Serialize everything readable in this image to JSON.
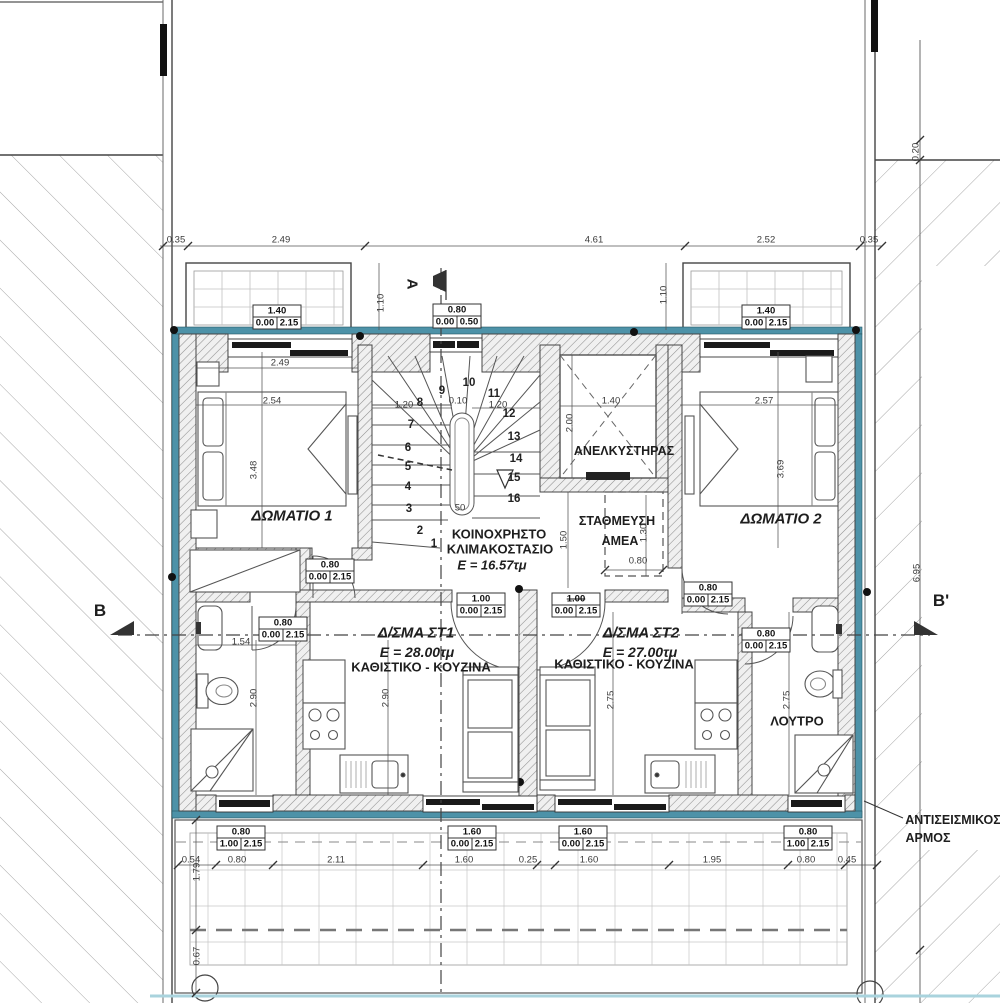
{
  "colors": {
    "insulation_teal": "#4d92a8",
    "pavement_line": "#a9d3dd",
    "wall_hatch": "#8f8f8f",
    "line": "#333333"
  },
  "labels": [
    {
      "name": "room-1-label",
      "text": "ΔΩΜΑΤΙΟ 1",
      "x": 292,
      "y": 516,
      "fs": 15,
      "b": 1,
      "i": 1
    },
    {
      "name": "room-2-label",
      "text": "ΔΩΜΑΤΙΟ 2",
      "x": 781,
      "y": 519,
      "fs": 15,
      "b": 1,
      "i": 1
    },
    {
      "name": "stairwell-label-line1",
      "text": "ΚΟΙΝΟΧΡΗΣΤΟ",
      "x": 499,
      "y": 534,
      "fs": 13,
      "b": 1
    },
    {
      "name": "stairwell-label-line2",
      "text": "ΚΛΙΜΑΚΟΣΤΑΣΙΟ",
      "x": 500,
      "y": 549,
      "fs": 13,
      "b": 1
    },
    {
      "name": "stairwell-area-label",
      "text": "E = 16.57τμ",
      "x": 492,
      "y": 565,
      "fs": 13,
      "b": 1,
      "i": 1
    },
    {
      "name": "elevator-label",
      "text": "ΑΝΕΛΚΥΣΤΗΡΑΣ",
      "x": 624,
      "y": 451,
      "fs": 12.5,
      "b": 1
    },
    {
      "name": "disabled-parking-label-line1",
      "text": "ΣΤΑΘΜΕΥΣΗ",
      "x": 617,
      "y": 521,
      "fs": 12.5,
      "b": 1
    },
    {
      "name": "disabled-parking-label-line2",
      "text": "ΑΜΕΑ",
      "x": 620,
      "y": 541,
      "fs": 12.5,
      "b": 1
    },
    {
      "name": "apartment-st1-label",
      "text": "Δ/ΣΜΑ ΣΤ1",
      "x": 416,
      "y": 633,
      "fs": 15,
      "b": 1,
      "i": 1
    },
    {
      "name": "apartment-st1-area",
      "text": "E = 28.00τμ",
      "x": 417,
      "y": 652,
      "fs": 14,
      "b": 1,
      "i": 1
    },
    {
      "name": "apartment-st1-room",
      "text": "ΚΑΘΙΣΤΙΚΟ - ΚΟΥΖΙΝΑ",
      "x": 421,
      "y": 667,
      "fs": 13,
      "b": 1
    },
    {
      "name": "apartment-st2-label",
      "text": "Δ/ΣΜΑ ΣΤ2",
      "x": 641,
      "y": 633,
      "fs": 15,
      "b": 1,
      "i": 1
    },
    {
      "name": "apartment-st2-area",
      "text": "E = 27.00τμ",
      "x": 640,
      "y": 652,
      "fs": 14,
      "b": 1,
      "i": 1
    },
    {
      "name": "apartment-st2-room",
      "text": "ΚΑΘΙΣΤΙΚΟ - ΚΟΥΖΙΝΑ",
      "x": 624,
      "y": 664,
      "fs": 13,
      "b": 1
    },
    {
      "name": "bathroom-label",
      "text": "ΛΟΥΤΡΟ",
      "x": 797,
      "y": 721,
      "fs": 13,
      "b": 1
    },
    {
      "name": "section-marker-b",
      "text": "B",
      "x": 100,
      "y": 611,
      "fs": 17,
      "b": 1
    },
    {
      "name": "section-marker-b-prime",
      "text": "B'",
      "x": 941,
      "y": 601,
      "fs": 17,
      "b": 1
    },
    {
      "name": "section-marker-a",
      "text": "A",
      "x": 412,
      "y": 284,
      "fs": 15,
      "b": 1,
      "rot": 90
    },
    {
      "name": "seismic-joint-label-line1",
      "text": "ΑΝΤΙΣΕΙΣΜΙΚΟΣ",
      "x": 953,
      "y": 820,
      "fs": 12.5,
      "b": 1
    },
    {
      "name": "seismic-joint-label-line2",
      "text": "ΑΡΜΟΣ",
      "x": 928,
      "y": 838,
      "fs": 12.5,
      "b": 1
    }
  ],
  "dimensions": [
    {
      "t": "0.35",
      "x": 176,
      "y": 240
    },
    {
      "t": "2.49",
      "x": 281,
      "y": 240
    },
    {
      "t": "4.61",
      "x": 594,
      "y": 240
    },
    {
      "t": "2.52",
      "x": 766,
      "y": 240
    },
    {
      "t": "0.35",
      "x": 869,
      "y": 240
    },
    {
      "t": "1.10",
      "x": 381,
      "y": 303,
      "rot": -90
    },
    {
      "t": "1.10",
      "x": 664,
      "y": 295,
      "rot": -90
    },
    {
      "t": "2.49",
      "x": 280,
      "y": 363
    },
    {
      "t": "2.54",
      "x": 272,
      "y": 401
    },
    {
      "t": "3.48",
      "x": 254,
      "y": 470,
      "rot": -90
    },
    {
      "t": "2.57",
      "x": 764,
      "y": 401
    },
    {
      "t": "3.69",
      "x": 781,
      "y": 469,
      "rot": -90
    },
    {
      "t": "1.40",
      "x": 611,
      "y": 401
    },
    {
      "t": "2.00",
      "x": 570,
      "y": 423,
      "rot": -90
    },
    {
      "t": "1.20",
      "x": 404,
      "y": 405
    },
    {
      "t": "0.10",
      "x": 458,
      "y": 401
    },
    {
      "t": "1.20",
      "x": 498,
      "y": 405
    },
    {
      "t": "1.50",
      "x": 564,
      "y": 540,
      "rot": -90
    },
    {
      "t": "1.30",
      "x": 644,
      "y": 533,
      "rot": -90
    },
    {
      "t": "0.80",
      "x": 638,
      "y": 561
    },
    {
      "t": "50",
      "x": 460,
      "y": 508
    },
    {
      "t": "1.54",
      "x": 241,
      "y": 642
    },
    {
      "t": "2.90",
      "x": 254,
      "y": 698,
      "rot": -90
    },
    {
      "t": "2.90",
      "x": 386,
      "y": 698,
      "rot": -90
    },
    {
      "t": "2.75",
      "x": 611,
      "y": 700,
      "rot": -90
    },
    {
      "t": "2.75",
      "x": 787,
      "y": 700,
      "rot": -90
    },
    {
      "t": "6.95",
      "x": 917,
      "y": 573,
      "rot": -90
    },
    {
      "t": "0.20",
      "x": 916,
      "y": 152,
      "rot": -90
    },
    {
      "t": "0.54",
      "x": 191,
      "y": 860
    },
    {
      "t": "0.80",
      "x": 237,
      "y": 860
    },
    {
      "t": "2.11",
      "x": 336,
      "y": 860
    },
    {
      "t": "1.60",
      "x": 464,
      "y": 860
    },
    {
      "t": "0.25",
      "x": 528,
      "y": 860
    },
    {
      "t": "1.60",
      "x": 589,
      "y": 860
    },
    {
      "t": "1.95",
      "x": 712,
      "y": 860
    },
    {
      "t": "0.80",
      "x": 806,
      "y": 860
    },
    {
      "t": "0.45",
      "x": 847,
      "y": 860
    },
    {
      "t": "1.79",
      "x": 197,
      "y": 872,
      "rot": -90
    },
    {
      "t": "0.67",
      "x": 197,
      "y": 956,
      "rot": -90
    }
  ],
  "stair_numbers": [
    {
      "n": "1",
      "x": 434,
      "y": 544
    },
    {
      "n": "2",
      "x": 420,
      "y": 531
    },
    {
      "n": "3",
      "x": 409,
      "y": 509
    },
    {
      "n": "4",
      "x": 408,
      "y": 487
    },
    {
      "n": "5",
      "x": 408,
      "y": 467
    },
    {
      "n": "6",
      "x": 408,
      "y": 448
    },
    {
      "n": "7",
      "x": 411,
      "y": 425
    },
    {
      "n": "8",
      "x": 420,
      "y": 403
    },
    {
      "n": "9",
      "x": 442,
      "y": 391
    },
    {
      "n": "10",
      "x": 469,
      "y": 383
    },
    {
      "n": "11",
      "x": 494,
      "y": 394
    },
    {
      "n": "12",
      "x": 509,
      "y": 414
    },
    {
      "n": "13",
      "x": 514,
      "y": 437
    },
    {
      "n": "14",
      "x": 516,
      "y": 459
    },
    {
      "n": "15",
      "x": 514,
      "y": 478
    },
    {
      "n": "16",
      "x": 514,
      "y": 499
    }
  ],
  "opening_tags": [
    {
      "w": "1.40",
      "a": "0.00",
      "b": "2.15",
      "x": 277,
      "y": 317
    },
    {
      "w": "0.80",
      "a": "0.00",
      "b": "0.50",
      "x": 457,
      "y": 316
    },
    {
      "w": "1.40",
      "a": "0.00",
      "b": "2.15",
      "x": 766,
      "y": 317
    },
    {
      "w": "0.80",
      "a": "0.00",
      "b": "2.15",
      "x": 330,
      "y": 571
    },
    {
      "w": "0.80",
      "a": "0.00",
      "b": "2.15",
      "x": 283,
      "y": 629
    },
    {
      "w": "1.00",
      "a": "0.00",
      "b": "2.15",
      "x": 481,
      "y": 605
    },
    {
      "w": "1.00",
      "a": "0.00",
      "b": "2.15",
      "x": 576,
      "y": 605,
      "strike": true
    },
    {
      "w": "0.80",
      "a": "0.00",
      "b": "2.15",
      "x": 708,
      "y": 594
    },
    {
      "w": "0.80",
      "a": "0.00",
      "b": "2.15",
      "x": 766,
      "y": 640
    },
    {
      "w": "0.80",
      "a": "1.00",
      "b": "2.15",
      "x": 241,
      "y": 838
    },
    {
      "w": "1.60",
      "a": "0.00",
      "b": "2.15",
      "x": 472,
      "y": 838
    },
    {
      "w": "1.60",
      "a": "0.00",
      "b": "2.15",
      "x": 583,
      "y": 838
    },
    {
      "w": "0.80",
      "a": "1.00",
      "b": "2.15",
      "x": 808,
      "y": 838
    }
  ]
}
